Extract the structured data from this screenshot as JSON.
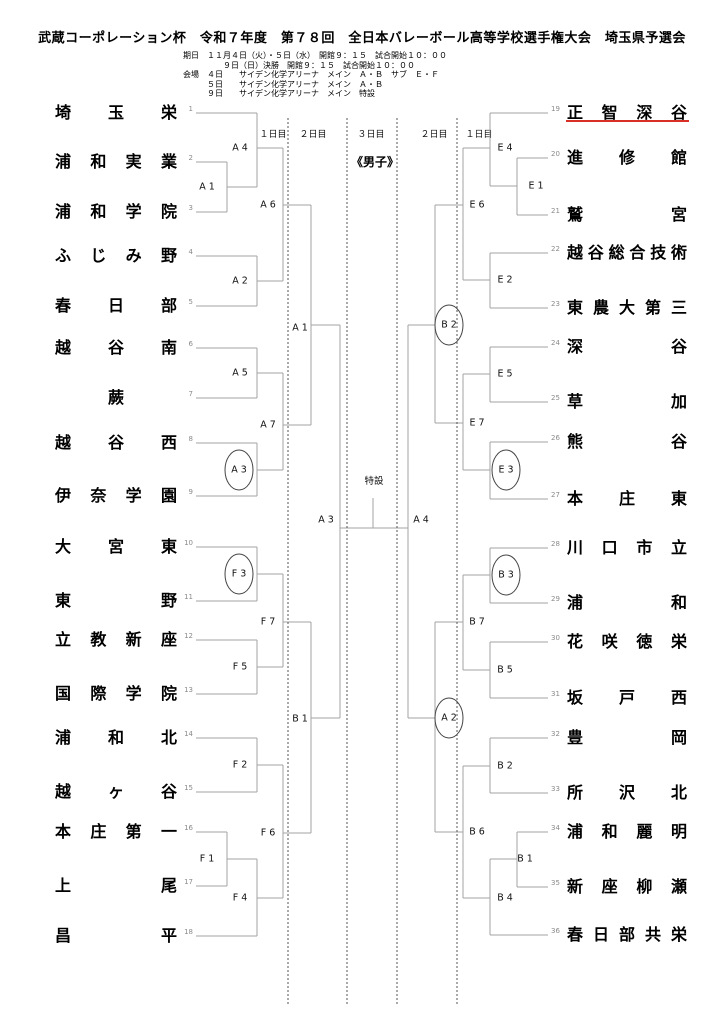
{
  "header": {
    "title": "武蔵コーポレーション杯　令和７年度　第７８回　全日本バレーボール高等学校選手権大会　埼玉県予選会",
    "schedule_lines": [
      "期日　１１月４日（火）・５日（水）　開館９：１５　試合開始１０：００",
      "　　　　　９日（日）決勝　開館９：１５　試合開始１０：００",
      "会場　４日　　サイデン化学アリーナ　メイン　Ａ・Ｂ　サブ　Ｅ・Ｆ",
      "　　　５日　　サイデン化学アリーナ　メイン　Ａ・Ｂ",
      "　　　９日　　サイデン化学アリーナ　メイン　特設"
    ]
  },
  "bracket": {
    "division_label": "《男子》",
    "final_court_label": "特設",
    "day_headers": [
      {
        "label": "１日目",
        "x": 273
      },
      {
        "label": "２日目",
        "x": 313
      },
      {
        "label": "３日目",
        "x": 371
      },
      {
        "label": "２日目",
        "x": 434
      },
      {
        "label": "１日目",
        "x": 479
      }
    ],
    "teams": [
      {
        "seed": "1",
        "name": "埼玉栄",
        "side": "left",
        "y": 113
      },
      {
        "seed": "2",
        "name": "浦和実業",
        "side": "left",
        "y": 162
      },
      {
        "seed": "3",
        "name": "浦和学院",
        "side": "left",
        "y": 212
      },
      {
        "seed": "4",
        "name": "ふじみ野",
        "side": "left",
        "y": 256
      },
      {
        "seed": "5",
        "name": "春日部",
        "side": "left",
        "y": 306
      },
      {
        "seed": "6",
        "name": "越谷南",
        "side": "left",
        "y": 348
      },
      {
        "seed": "7",
        "name": "蕨",
        "side": "left",
        "y": 398
      },
      {
        "seed": "8",
        "name": "越谷西",
        "side": "left",
        "y": 443
      },
      {
        "seed": "9",
        "name": "伊奈学園",
        "side": "left",
        "y": 496
      },
      {
        "seed": "10",
        "name": "大宮東",
        "side": "left",
        "y": 547
      },
      {
        "seed": "11",
        "name": "東野",
        "side": "left",
        "y": 601
      },
      {
        "seed": "12",
        "name": "立教新座",
        "side": "left",
        "y": 640
      },
      {
        "seed": "13",
        "name": "国際学院",
        "side": "left",
        "y": 694
      },
      {
        "seed": "14",
        "name": "浦和北",
        "side": "left",
        "y": 738
      },
      {
        "seed": "15",
        "name": "越ヶ谷",
        "side": "left",
        "y": 792
      },
      {
        "seed": "16",
        "name": "本庄第一",
        "side": "left",
        "y": 832
      },
      {
        "seed": "17",
        "name": "上尾",
        "side": "left",
        "y": 886
      },
      {
        "seed": "18",
        "name": "昌平",
        "side": "left",
        "y": 936
      },
      {
        "seed": "19",
        "name": "正智深谷",
        "side": "right",
        "y": 113,
        "underlined": true
      },
      {
        "seed": "20",
        "name": "進修館",
        "side": "right",
        "y": 158
      },
      {
        "seed": "21",
        "name": "鷲宮",
        "side": "right",
        "y": 215
      },
      {
        "seed": "22",
        "name": "越谷総合技術",
        "side": "right",
        "y": 253
      },
      {
        "seed": "23",
        "name": "東農大第三",
        "side": "right",
        "y": 308
      },
      {
        "seed": "24",
        "name": "深谷",
        "side": "right",
        "y": 347
      },
      {
        "seed": "25",
        "name": "草加",
        "side": "right",
        "y": 402
      },
      {
        "seed": "26",
        "name": "熊谷",
        "side": "right",
        "y": 442
      },
      {
        "seed": "27",
        "name": "本庄東",
        "side": "right",
        "y": 499
      },
      {
        "seed": "28",
        "name": "川口市立",
        "side": "right",
        "y": 548
      },
      {
        "seed": "29",
        "name": "浦和",
        "side": "right",
        "y": 603
      },
      {
        "seed": "30",
        "name": "花咲徳栄",
        "side": "right",
        "y": 642
      },
      {
        "seed": "31",
        "name": "坂戸西",
        "side": "right",
        "y": 698
      },
      {
        "seed": "32",
        "name": "豊岡",
        "side": "right",
        "y": 738
      },
      {
        "seed": "33",
        "name": "所沢北",
        "side": "right",
        "y": 793
      },
      {
        "seed": "34",
        "name": "浦和麗明",
        "side": "right",
        "y": 832
      },
      {
        "seed": "35",
        "name": "新座柳瀬",
        "side": "right",
        "y": 887
      },
      {
        "seed": "36",
        "name": "春日部共栄",
        "side": "right",
        "y": 935
      }
    ],
    "match_labels": [
      {
        "code": "A 4",
        "x": 240,
        "y": 148
      },
      {
        "code": "A 1",
        "x": 207,
        "y": 187
      },
      {
        "code": "A 6",
        "x": 268,
        "y": 205
      },
      {
        "code": "A 2",
        "x": 240,
        "y": 281
      },
      {
        "code": "A 1",
        "x": 300,
        "y": 328
      },
      {
        "code": "A 5",
        "x": 240,
        "y": 373
      },
      {
        "code": "A 7",
        "x": 268,
        "y": 425
      },
      {
        "code": "A 3",
        "x": 239,
        "y": 470,
        "circled": true
      },
      {
        "code": "A 3",
        "x": 326,
        "y": 520
      },
      {
        "code": "F 3",
        "x": 239,
        "y": 574,
        "circled": true
      },
      {
        "code": "F 7",
        "x": 268,
        "y": 622
      },
      {
        "code": "F 5",
        "x": 240,
        "y": 667
      },
      {
        "code": "B 1",
        "x": 300,
        "y": 719
      },
      {
        "code": "F 2",
        "x": 240,
        "y": 765
      },
      {
        "code": "F 6",
        "x": 268,
        "y": 833
      },
      {
        "code": "F 1",
        "x": 207,
        "y": 859
      },
      {
        "code": "F 4",
        "x": 240,
        "y": 898
      },
      {
        "code": "E 4",
        "x": 505,
        "y": 148
      },
      {
        "code": "E 1",
        "x": 536,
        "y": 186
      },
      {
        "code": "E 6",
        "x": 477,
        "y": 205
      },
      {
        "code": "E 2",
        "x": 505,
        "y": 280
      },
      {
        "code": "B 2",
        "x": 449,
        "y": 325,
        "circled": true
      },
      {
        "code": "E 5",
        "x": 505,
        "y": 374
      },
      {
        "code": "E 7",
        "x": 477,
        "y": 423
      },
      {
        "code": "E 3",
        "x": 506,
        "y": 470,
        "circled": true
      },
      {
        "code": "A 4",
        "x": 421,
        "y": 520
      },
      {
        "code": "B 3",
        "x": 506,
        "y": 575,
        "circled": true
      },
      {
        "code": "B 7",
        "x": 477,
        "y": 622
      },
      {
        "code": "B 5",
        "x": 505,
        "y": 670
      },
      {
        "code": "A 2",
        "x": 449,
        "y": 718,
        "circled": true
      },
      {
        "code": "B 2",
        "x": 505,
        "y": 766
      },
      {
        "code": "B 6",
        "x": 477,
        "y": 832
      },
      {
        "code": "B 1",
        "x": 525,
        "y": 859
      },
      {
        "code": "B 4",
        "x": 505,
        "y": 898
      }
    ],
    "segments": [
      [
        196,
        113,
        257,
        113
      ],
      [
        196,
        162,
        227,
        162
      ],
      [
        196,
        212,
        227,
        212
      ],
      [
        196,
        256,
        257,
        256
      ],
      [
        196,
        306,
        257,
        306
      ],
      [
        196,
        348,
        257,
        348
      ],
      [
        196,
        398,
        257,
        398
      ],
      [
        196,
        443,
        257,
        443
      ],
      [
        196,
        496,
        257,
        496
      ],
      [
        196,
        547,
        257,
        547
      ],
      [
        196,
        601,
        257,
        601
      ],
      [
        196,
        640,
        257,
        640
      ],
      [
        196,
        694,
        257,
        694
      ],
      [
        196,
        738,
        257,
        738
      ],
      [
        196,
        792,
        257,
        792
      ],
      [
        196,
        832,
        227,
        832
      ],
      [
        196,
        886,
        227,
        886
      ],
      [
        196,
        936,
        257,
        936
      ],
      [
        227,
        162,
        227,
        212
      ],
      [
        257,
        113,
        257,
        187
      ],
      [
        257,
        256,
        257,
        306
      ],
      [
        257,
        348,
        257,
        398
      ],
      [
        257,
        443,
        257,
        496
      ],
      [
        257,
        547,
        257,
        601
      ],
      [
        257,
        640,
        257,
        694
      ],
      [
        257,
        738,
        257,
        792
      ],
      [
        227,
        832,
        227,
        886
      ],
      [
        257,
        859,
        257,
        936
      ],
      [
        283,
        148,
        283,
        281
      ],
      [
        283,
        373,
        283,
        470
      ],
      [
        283,
        574,
        283,
        667
      ],
      [
        283,
        765,
        283,
        898
      ],
      [
        311,
        205,
        311,
        425
      ],
      [
        311,
        622,
        311,
        833
      ],
      [
        340,
        325,
        340,
        718
      ],
      [
        227,
        187,
        257,
        187
      ],
      [
        257,
        148,
        283,
        148
      ],
      [
        257,
        281,
        283,
        281
      ],
      [
        257,
        373,
        283,
        373
      ],
      [
        257,
        470,
        283,
        470
      ],
      [
        257,
        574,
        283,
        574
      ],
      [
        257,
        667,
        283,
        667
      ],
      [
        257,
        765,
        283,
        765
      ],
      [
        227,
        859,
        257,
        859
      ],
      [
        257,
        898,
        283,
        898
      ],
      [
        283,
        205,
        311,
        205
      ],
      [
        283,
        425,
        311,
        425
      ],
      [
        283,
        622,
        311,
        622
      ],
      [
        283,
        833,
        311,
        833
      ],
      [
        311,
        325,
        340,
        325
      ],
      [
        311,
        718,
        340,
        718
      ],
      [
        340,
        528,
        408,
        528
      ],
      [
        490,
        113,
        548,
        113
      ],
      [
        517,
        158,
        548,
        158
      ],
      [
        517,
        215,
        548,
        215
      ],
      [
        490,
        253,
        548,
        253
      ],
      [
        490,
        308,
        548,
        308
      ],
      [
        490,
        347,
        548,
        347
      ],
      [
        490,
        402,
        548,
        402
      ],
      [
        490,
        442,
        548,
        442
      ],
      [
        490,
        499,
        548,
        499
      ],
      [
        490,
        548,
        548,
        548
      ],
      [
        490,
        603,
        548,
        603
      ],
      [
        490,
        642,
        548,
        642
      ],
      [
        490,
        698,
        548,
        698
      ],
      [
        490,
        738,
        548,
        738
      ],
      [
        490,
        793,
        548,
        793
      ],
      [
        517,
        832,
        548,
        832
      ],
      [
        517,
        887,
        548,
        887
      ],
      [
        490,
        935,
        548,
        935
      ],
      [
        517,
        158,
        517,
        215
      ],
      [
        490,
        113,
        490,
        186
      ],
      [
        490,
        253,
        490,
        308
      ],
      [
        490,
        347,
        490,
        402
      ],
      [
        490,
        442,
        490,
        499
      ],
      [
        490,
        548,
        490,
        603
      ],
      [
        490,
        642,
        490,
        698
      ],
      [
        490,
        738,
        490,
        793
      ],
      [
        517,
        832,
        517,
        887
      ],
      [
        490,
        859,
        490,
        935
      ],
      [
        463,
        148,
        463,
        280
      ],
      [
        463,
        374,
        463,
        470
      ],
      [
        463,
        575,
        463,
        670
      ],
      [
        463,
        766,
        463,
        898
      ],
      [
        435,
        205,
        435,
        423
      ],
      [
        435,
        622,
        435,
        832
      ],
      [
        408,
        325,
        408,
        718
      ],
      [
        490,
        186,
        517,
        186
      ],
      [
        463,
        148,
        490,
        148
      ],
      [
        463,
        280,
        490,
        280
      ],
      [
        463,
        374,
        490,
        374
      ],
      [
        463,
        470,
        490,
        470
      ],
      [
        463,
        575,
        490,
        575
      ],
      [
        463,
        670,
        490,
        670
      ],
      [
        463,
        766,
        490,
        766
      ],
      [
        490,
        859,
        517,
        859
      ],
      [
        463,
        898,
        490,
        898
      ],
      [
        435,
        205,
        463,
        205
      ],
      [
        435,
        423,
        463,
        423
      ],
      [
        435,
        622,
        463,
        622
      ],
      [
        435,
        832,
        463,
        832
      ],
      [
        408,
        325,
        435,
        325
      ],
      [
        408,
        718,
        435,
        718
      ]
    ],
    "dashed_columns": {
      "xs": [
        288,
        347,
        397,
        457
      ],
      "y1": 118,
      "y2": 1006
    },
    "final_tick": {
      "x": 373,
      "y1": 498,
      "y2": 528
    },
    "highlight_underline": {
      "seed": "19",
      "x1": 566,
      "x2": 689,
      "y": 120
    }
  },
  "layout_labels": {
    "left_name_x": 55,
    "left_name_w": 122,
    "right_name_x": 567,
    "right_name_w": 120
  },
  "colors": {
    "line": "#a3a3a3",
    "dashed": "#555555",
    "circle": "#444444",
    "underline": "#d93025",
    "seed": "#8a8a8a",
    "text": "#000000"
  }
}
